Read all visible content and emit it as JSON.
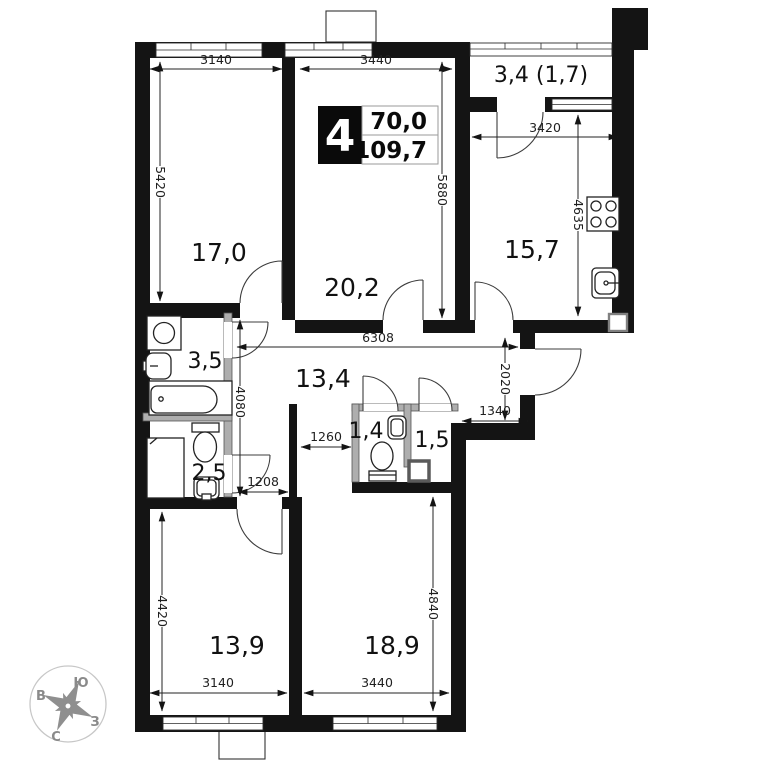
{
  "plan": {
    "badge": {
      "rooms": "4",
      "area_living": "70,0",
      "area_total": "109,7"
    },
    "rooms": {
      "r17": "17,0",
      "r202": "20,2",
      "balcony": "3,4 (1,7)",
      "kitchen": "15,7",
      "bath": "3,5",
      "hall": "13,4",
      "wc_small": "2,5",
      "wc_tiny": "1,4",
      "storage": "1,5",
      "r139": "13,9",
      "r189": "18,9"
    },
    "dims": {
      "w3140t": "3140",
      "w3440t": "3440",
      "h5420": "5420",
      "h5880": "5880",
      "w3420": "3420",
      "h4635": "4635",
      "w6308": "6308",
      "h4080": "4080",
      "h2020": "2020",
      "w1340": "1340",
      "w1260": "1260",
      "w1208": "1208",
      "h4420": "4420",
      "w3140b": "3140",
      "w3440b": "3440",
      "h4840": "4840"
    },
    "compass": {
      "top": "Ю",
      "left": "В",
      "right": "З",
      "bottom": "С"
    }
  }
}
